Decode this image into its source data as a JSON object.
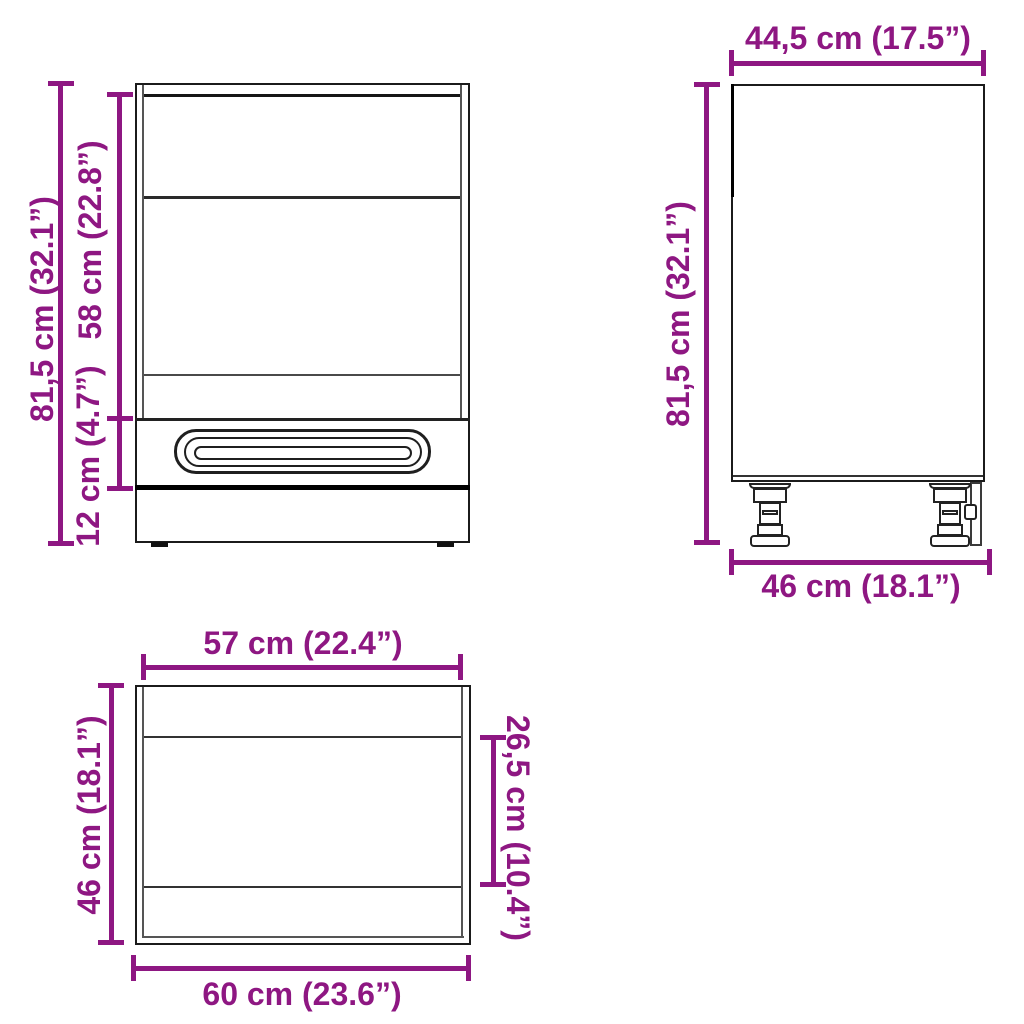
{
  "colors": {
    "accent": "#8E1782",
    "line": "#1B1B1B"
  },
  "views": {
    "front": {
      "height_label": "81,5 cm (32.1”)",
      "cavity_label": "58 cm (22.8”)",
      "drawer_label": "12 cm (4.7”)"
    },
    "side": {
      "depth_top_label": "44,5 cm (17.5”)",
      "height_label": "81,5 cm (32.1”)",
      "depth_bottom_label": "46 cm (18.1”)"
    },
    "top": {
      "width_inner_label": "57 cm (22.4”)",
      "depth_label": "46 cm (18.1”)",
      "depth_partial_label": "26,5 cm (10.4”)",
      "width_outer_label": "60 cm (23.6”)"
    }
  }
}
